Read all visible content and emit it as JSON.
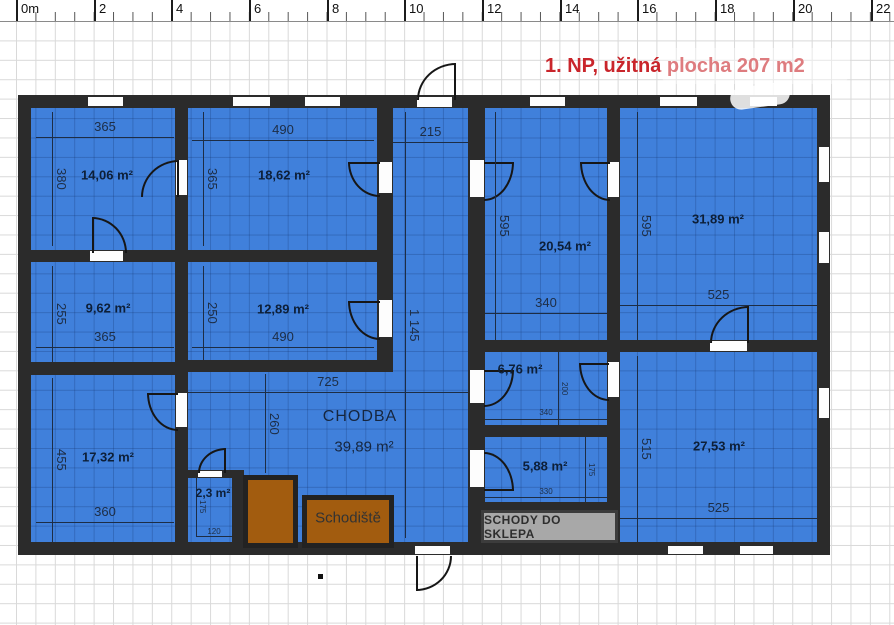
{
  "title": "1. NP, užitná plocha 207 m2",
  "ruler": [
    "0m",
    "2",
    "4",
    "6",
    "8",
    "10",
    "12",
    "14",
    "16",
    "18",
    "20",
    "22"
  ],
  "rooms": {
    "r14": {
      "area": "14,06 m²",
      "w": "365",
      "h": "380"
    },
    "r18": {
      "area": "18,62 m²",
      "w": "490",
      "h": "365"
    },
    "hall": {
      "w": "215",
      "h": "1 145"
    },
    "r20": {
      "area": "20,54 m²",
      "w": "340",
      "h": "595"
    },
    "r31": {
      "area": "31,89 m²",
      "w": "525",
      "h": "595"
    },
    "r9": {
      "area": "9,62 m²",
      "w": "365",
      "h": "255"
    },
    "r12": {
      "area": "12,89 m²",
      "w": "490",
      "h": "250"
    },
    "chodba": {
      "name": "CHODBA",
      "area": "39,89 m²",
      "w": "725",
      "h": "260"
    },
    "r17": {
      "area": "17,32 m²",
      "w": "360",
      "h": "455"
    },
    "r2": {
      "area": "2,3 m²",
      "w": "120",
      "h": "175"
    },
    "r6": {
      "area": "6,76 m²",
      "w": "340",
      "h": "200"
    },
    "r5": {
      "area": "5,88 m²",
      "w": "330",
      "h": "175"
    },
    "r27": {
      "area": "27,53 m²",
      "w": "525",
      "h": "515"
    },
    "stairs": {
      "name": "Schodiště"
    },
    "basement_stairs": {
      "name": "SCHODY DO SKLEPA"
    }
  },
  "colors": {
    "room_fill": "#4080db",
    "wall": "#2b2b2b",
    "stairs_fill": "#a25c0f",
    "basement_box_fill": "#a8a8a8",
    "title": "#c9252b",
    "dimension_text": "#1d2d45"
  }
}
